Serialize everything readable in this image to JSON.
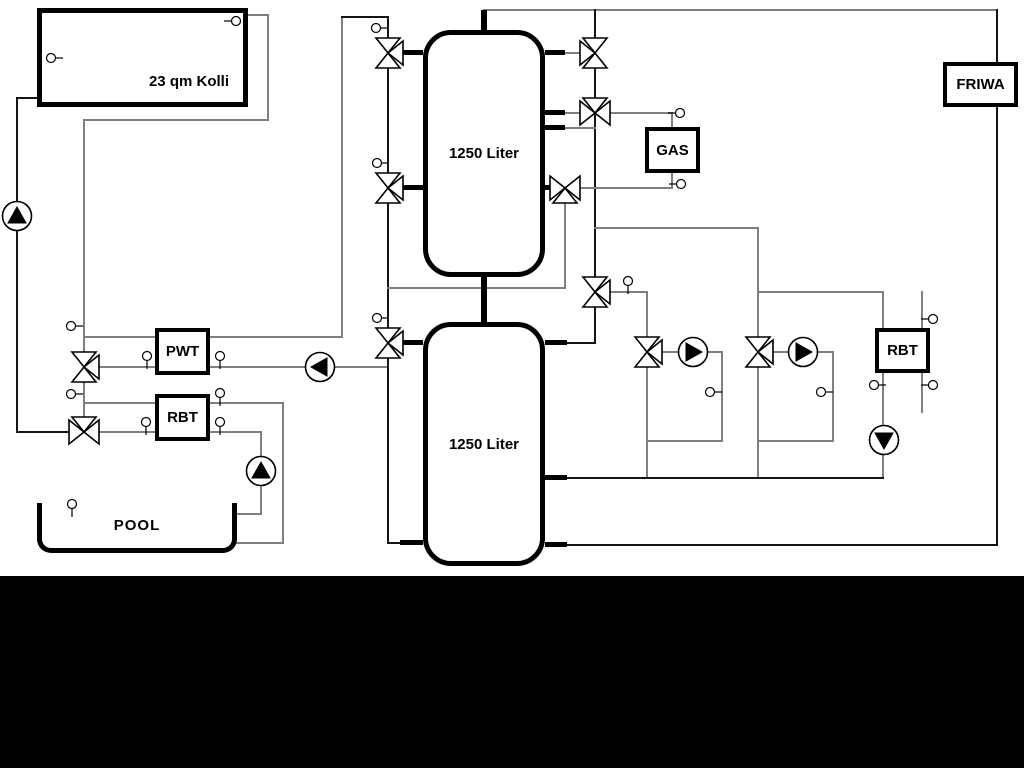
{
  "diagram": {
    "collector": {
      "label": "23 qm Kolli"
    },
    "buffer_tank_top": {
      "label": "1250 Liter"
    },
    "buffer_tank_bottom": {
      "label": "1250 Liter"
    },
    "pwt": {
      "label": "PWT"
    },
    "rbt_left": {
      "label": "RBT"
    },
    "rbt_right": {
      "label": "RBT"
    },
    "gas_boiler": {
      "label": "GAS"
    },
    "friwa": {
      "label": "FRIWA"
    },
    "pool": {
      "label": "POOL"
    },
    "colors": {
      "pipe_gray": "#7f7f7f",
      "pipe_dark": "#151515",
      "stub_black": "#000000",
      "symbol_stroke": "#000000",
      "symbol_fill": "#ffffff",
      "footer_bar": "#000000",
      "background": "#ffffff"
    }
  }
}
